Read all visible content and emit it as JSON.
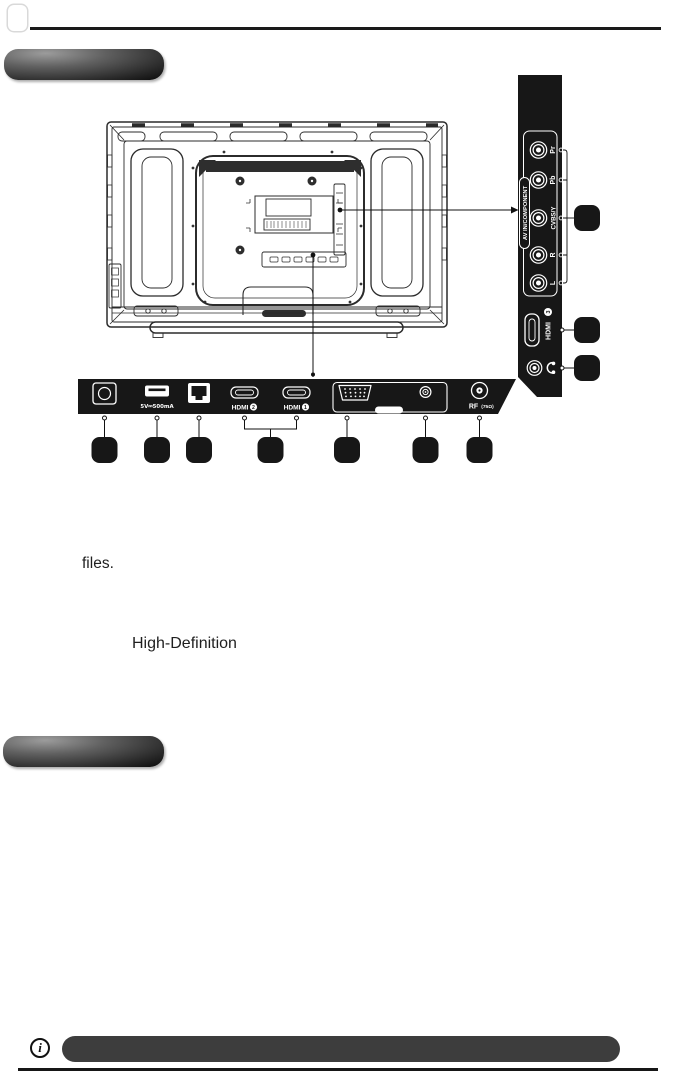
{
  "document": {
    "fragments": {
      "line1": "files.",
      "line2": "High-Definition"
    },
    "info_symbol": "i"
  },
  "diagram": {
    "side_panel": {
      "av_group_label": "AV IN/COMPONENT",
      "jack_labels": [
        "Pr",
        "Pb",
        "CVBS/Y",
        "R",
        "L"
      ],
      "hdmi_label": "HDMI",
      "hdmi_number": "3"
    },
    "bottom_panel": {
      "usb_power_label": "5V⎓500mA",
      "hdmi2_label": "HDMI",
      "hdmi2_number": "2",
      "hdmi1_label": "HDMI",
      "hdmi1_number": "1",
      "rf_label": "RF",
      "rf_impedance": "(75Ω)"
    }
  },
  "colors": {
    "panel_black": "#171717",
    "line_color": "#2b2b2b",
    "note_bar": "#3d3d3d"
  }
}
